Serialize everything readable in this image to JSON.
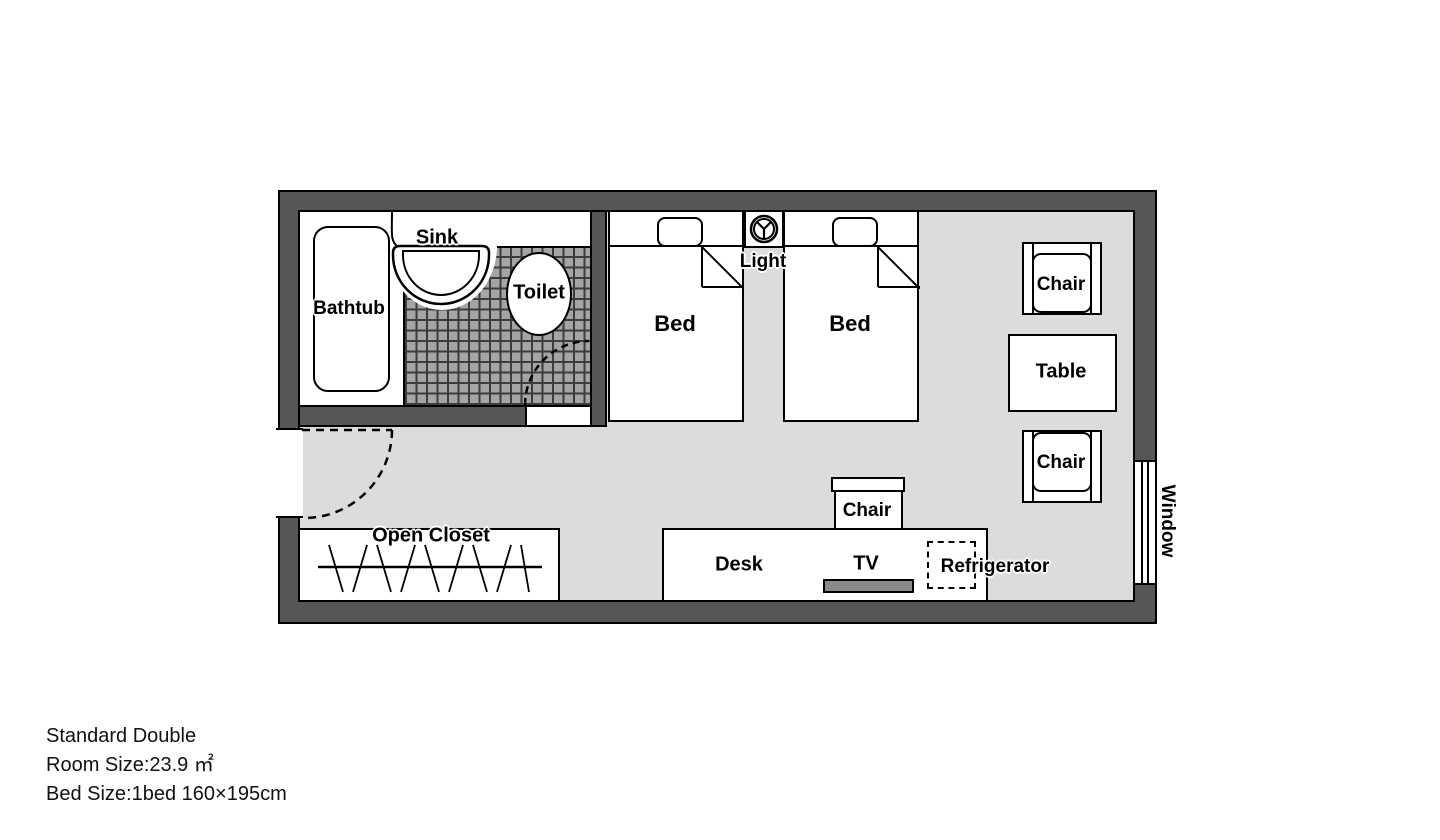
{
  "floorplan": {
    "bathroom": {
      "bathtub": "Bathtub",
      "sink": "Sink",
      "toilet": "Toilet"
    },
    "sleeping_area": {
      "bed_left": "Bed",
      "bed_right": "Bed",
      "light": "Light"
    },
    "sitting_area": {
      "chair_top": "Chair",
      "table": "Table",
      "chair_bottom": "Chair"
    },
    "work_area": {
      "desk": "Desk",
      "tv": "TV",
      "desk_chair": "Chair",
      "refrigerator": "Refrigerator"
    },
    "entry_area": {
      "open_closet": "Open Closet"
    },
    "window": "Window"
  },
  "caption": {
    "room_type": "Standard Double",
    "room_size": "Room Size:23.9 ㎡",
    "bed_size": "Bed Size:1bed 160×195cm"
  },
  "colors": {
    "wall": "#585654",
    "floor": "#dcdcdc",
    "tile": "#a5a5a5",
    "tile_grid": "#3c3c3c",
    "tv": "#8a8a8a",
    "outline": "#000000"
  }
}
